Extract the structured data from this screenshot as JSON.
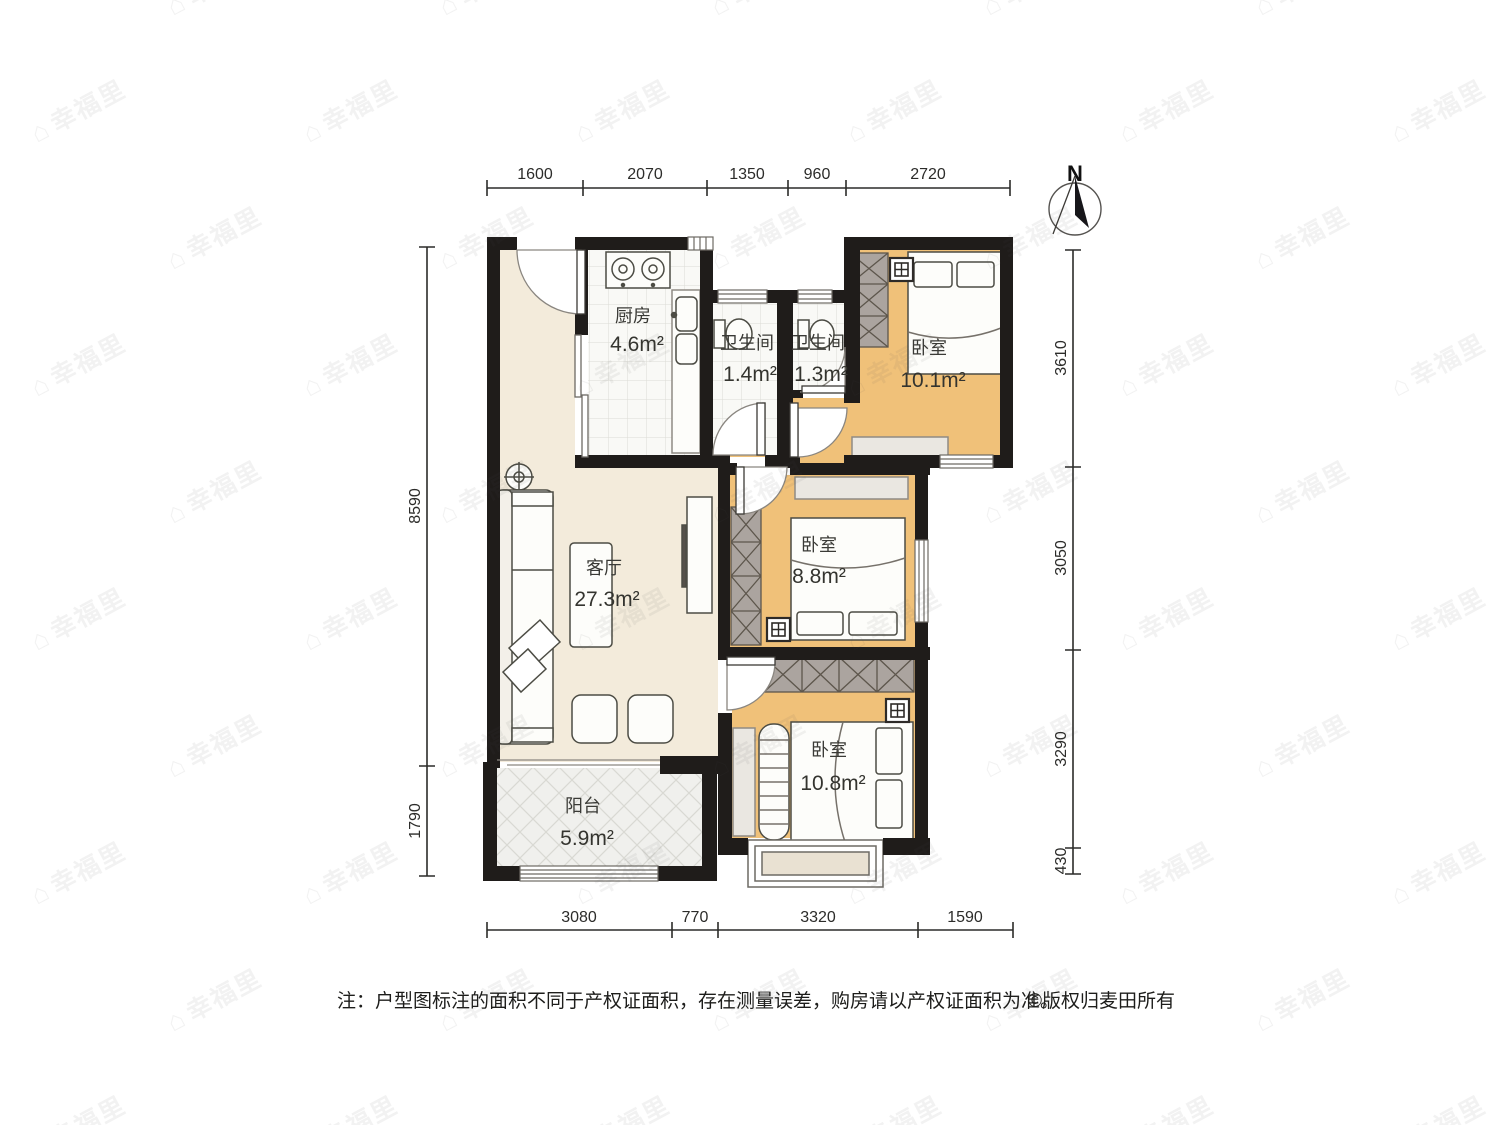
{
  "title": "户型图",
  "watermark": {
    "icon": "house-icon",
    "text": "幸福里"
  },
  "compass": {
    "label": "N"
  },
  "rooms": [
    {
      "id": "kitchen",
      "name": "厨房",
      "area": "4.6m²"
    },
    {
      "id": "bathroom-1",
      "name": "卫生间",
      "area": "1.4m²"
    },
    {
      "id": "bathroom-2",
      "name": "卫生间",
      "area": "1.3m²"
    },
    {
      "id": "bedroom-north",
      "name": "卧室",
      "area": "10.1m²"
    },
    {
      "id": "living-room",
      "name": "客厅",
      "area": "27.3m²"
    },
    {
      "id": "bedroom-middle",
      "name": "卧室",
      "area": "8.8m²"
    },
    {
      "id": "bedroom-south",
      "name": "卧室",
      "area": "10.8m²"
    },
    {
      "id": "balcony",
      "name": "阳台",
      "area": "5.9m²"
    }
  ],
  "dimensions": {
    "top": [
      "1600",
      "2070",
      "1350",
      "960",
      "2720"
    ],
    "bottom": [
      "3080",
      "770",
      "3320",
      "1590"
    ],
    "left": [
      "8590",
      "1790"
    ],
    "right": [
      "3610",
      "3050",
      "3290",
      "430"
    ]
  },
  "footnote": {
    "note": "注：户型图标注的面积不同于产权证面积，存在测量误差，购房请以产权证面积为准。",
    "copyright": "©版权归麦田所有"
  },
  "colors": {
    "wall": "#1f1c1a",
    "wood_floor": "#f0c179",
    "living_floor": "#f3ebdb",
    "tile_floor": "#f9f9f6",
    "balcony_floor": "#f0f0ed",
    "wardrobe": "#aba49f",
    "furniture_gray": "#eae7e1",
    "dimension_text": "#2c2c2a"
  }
}
